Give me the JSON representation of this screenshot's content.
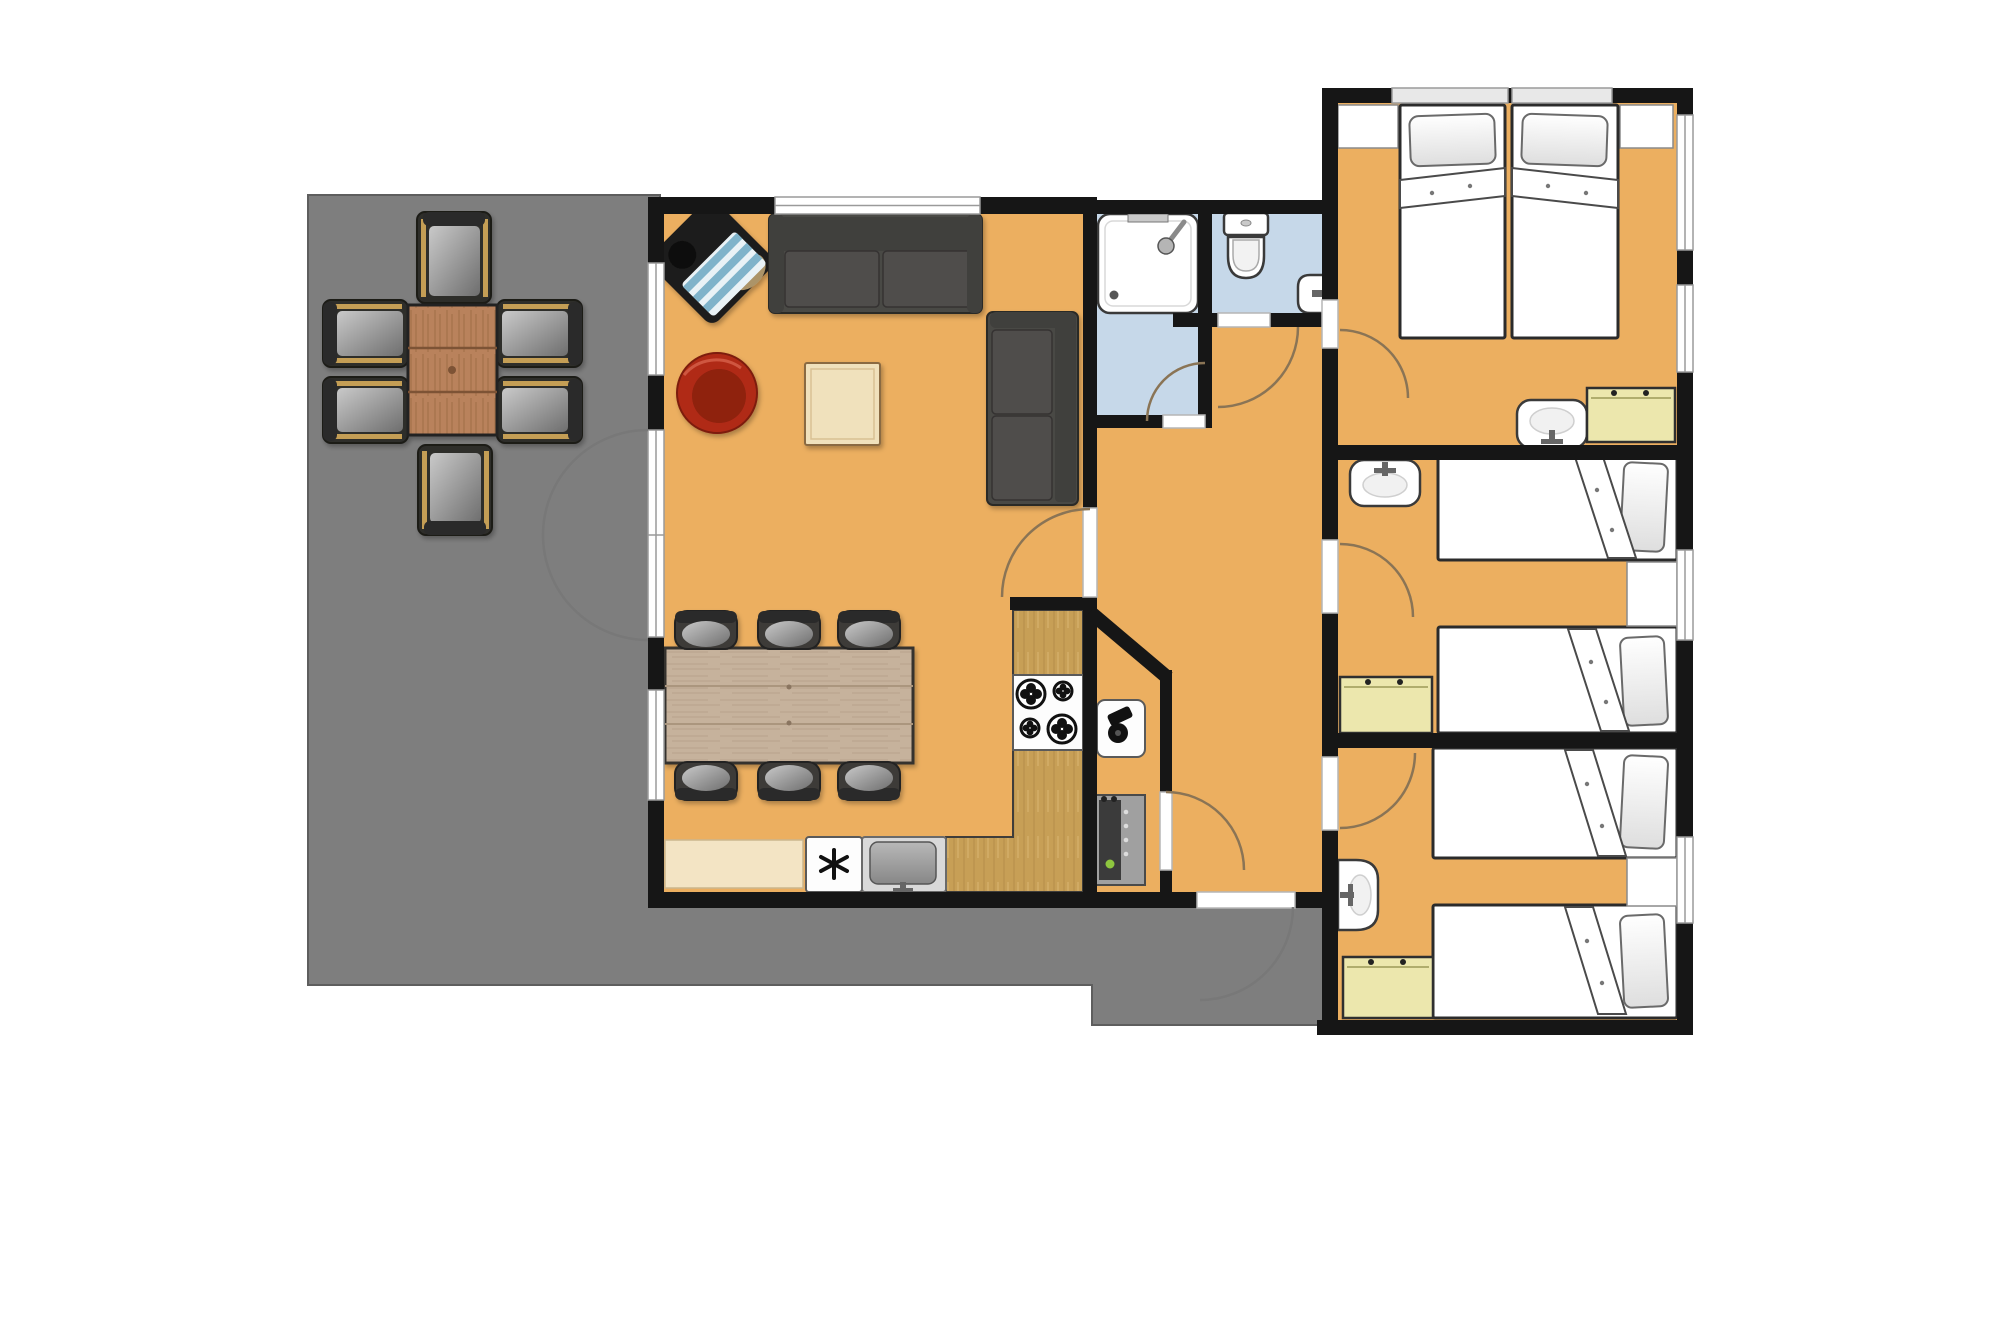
{
  "meta": {
    "type": "holiday-home floor plan",
    "visible_text": ""
  },
  "palette": {
    "floor": "#ECAF60",
    "terrace": "#7E7E7E",
    "terrace_outline": "#5E5E5E",
    "wall": "#161616",
    "bath_floor": "#C6D8E9",
    "window_white": "#FFFFFF",
    "frame_gray": "#9A9A9A",
    "arc_interior": "#8A7455",
    "arc_exterior": "#787878",
    "sofa": "#4A4845",
    "sofa_dark": "#413F3D",
    "sofa_cushion": "#504E4B",
    "bed_outline": "#2B2B2B",
    "pillow_edge": "#6A6A6A",
    "wardrobe": "#ECE7AD",
    "wardrobe_edge": "#2F2F2F",
    "fixture_outline": "#3A3A3A",
    "chair_body": "#3C3B39",
    "chair_back": "#2C2B29",
    "outdoor_chair": "#2E2D2B",
    "armrest_tan": "#C49E55",
    "bench": "#F3E4C4",
    "appliance_white": "#FDFDFD",
    "steel": "#D9D9D9",
    "counter_wood": "#C79F56",
    "dining_table": "#C6B29C",
    "plank_line": "#AB967E",
    "outdoor_table": "#B9825C",
    "outdoor_plank": "#7D5234",
    "coffee_table": "#F0E1BC",
    "coffee_table_edge": "#8A6A42",
    "red_chair": "#B02C17",
    "red_chair_dark": "#8F2010",
    "heater_gray": "#A0A0A0",
    "heater_panel": "#3B3B3B",
    "green_indicator": "#8EC63F",
    "stripe_blue": "#7FB3CA",
    "stripe_light": "#E9F2F6",
    "lounge_black": "#1D1C1B",
    "lounge_beige": "#AC9468"
  },
  "rooms": [
    {
      "name": "terrace",
      "floor": "gray"
    },
    {
      "name": "living-room",
      "floor": "orange"
    },
    {
      "name": "kitchen-dining",
      "floor": "orange"
    },
    {
      "name": "shower-room",
      "floor": "light-blue"
    },
    {
      "name": "wc",
      "floor": "light-blue"
    },
    {
      "name": "hallway",
      "floor": "orange"
    },
    {
      "name": "storage-closet",
      "floor": "orange"
    },
    {
      "name": "bedroom-1",
      "beds": "2 singles pushed together (double)"
    },
    {
      "name": "bedroom-2",
      "beds": "2 singles"
    },
    {
      "name": "bedroom-3",
      "beds": "2 singles"
    }
  ],
  "furniture": {
    "terrace": [
      "outdoor-table",
      "outdoor-chair x6"
    ],
    "living_room": [
      "striped-lounge-chair",
      "sofa-3-seat",
      "sofa-2-seat",
      "coffee-table",
      "red-round-armchair",
      "dining-table",
      "dining-chair x6"
    ],
    "kitchen": [
      "bench-counter",
      "freezer",
      "kitchen-sink",
      "l-shaped-counter",
      "stove-4-burners"
    ],
    "storage_closet": [
      "water-heater-unit",
      "boiler-cabinet"
    ],
    "shower_room": [
      "shower-tray",
      "shower-head"
    ],
    "wc": [
      "toilet",
      "wall-sink"
    ],
    "bedroom_1": [
      "bed x2",
      "pillow x2",
      "corner-table x2",
      "sink",
      "wardrobe"
    ],
    "bedroom_2": [
      "bed x2",
      "pillow x2",
      "nightstand",
      "sink",
      "wardrobe"
    ],
    "bedroom_3": [
      "bed x2",
      "pillow x2",
      "nightstand",
      "sink",
      "wardrobe"
    ]
  },
  "icons": [
    "freezer-star-icon",
    "stove-burner-icon",
    "faucet-icon",
    "shower-head-icon",
    "drain-icon"
  ]
}
